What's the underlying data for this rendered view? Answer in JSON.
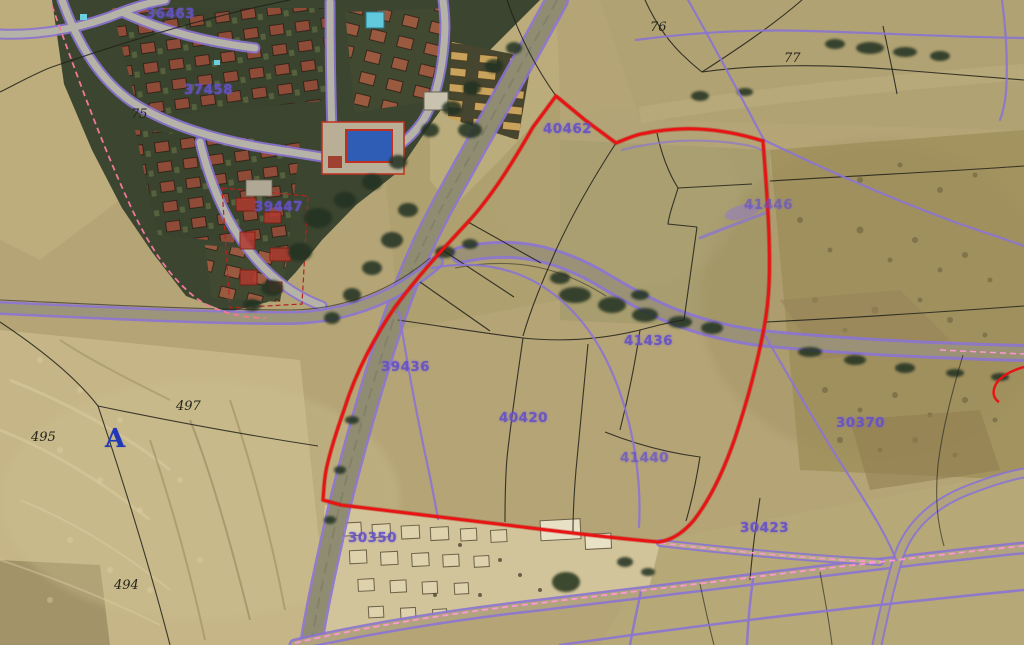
{
  "map": {
    "kind": "aerial-cadastral-map",
    "colors": {
      "selected_parcel": "#e81414",
      "cadastral": "#8b74d2",
      "parcel_lines": "#20201a",
      "survey_pink": "#ff97d2",
      "label_purple": "#6552c6",
      "label_black": "#23231a",
      "marker_blue": "#2038b8"
    }
  },
  "labels": {
    "parcels": [
      "36463",
      "37458",
      "39447",
      "40462",
      "41446",
      "41436",
      "39436",
      "40420",
      "41440",
      "30370",
      "30350",
      "30423"
    ],
    "references": [
      "75",
      "76",
      "77",
      "497",
      "495",
      "494"
    ],
    "marker": "A"
  }
}
